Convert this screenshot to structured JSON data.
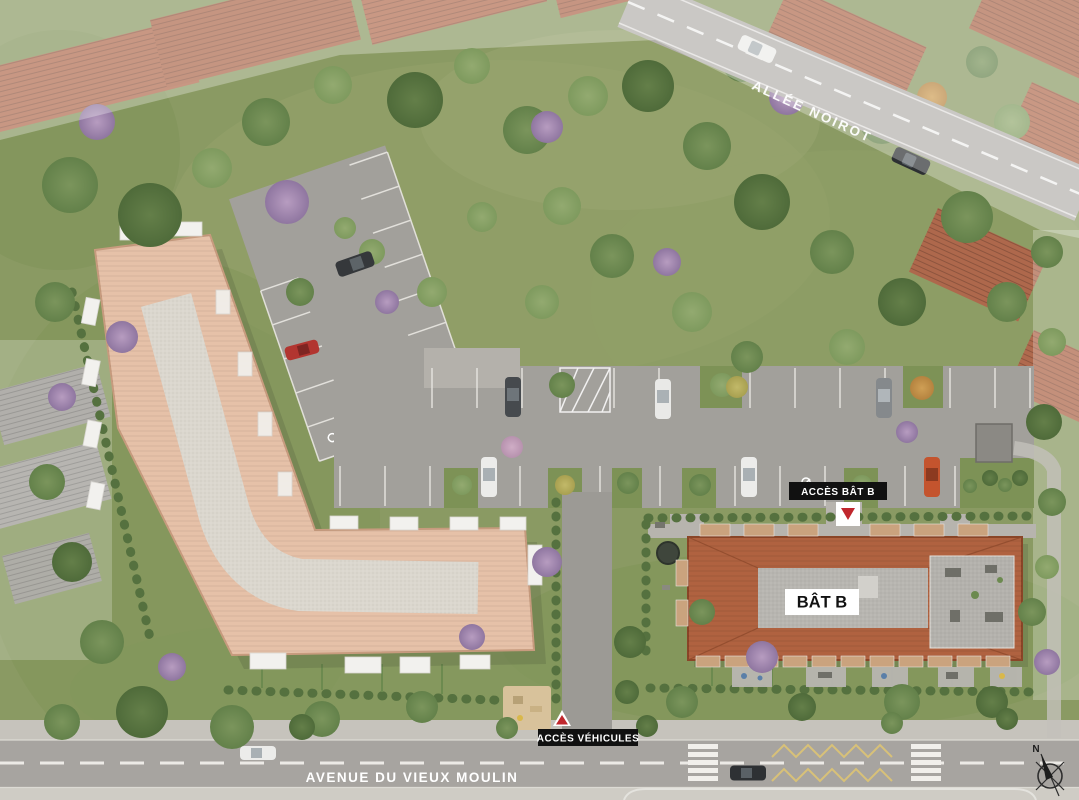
{
  "plan": {
    "type": "residential-site-plan",
    "streets": {
      "top_street": "ALLÉE NOIROT",
      "bottom_street": "AVENUE DU VIEUX MOULIN"
    },
    "buildings": {
      "building_b_label": "BÂT B"
    },
    "markers": {
      "access_building_b": "ACCÈS BÂT B",
      "access_vehicles": "ACCÈS VÉHICULES"
    },
    "compass": {
      "north": "N"
    },
    "colors": {
      "grass": "#8a9a63",
      "asphalt_parking": "#a2a09b",
      "asphalt_road": "#a7a4a0",
      "sidewalk": "#c6c3bc",
      "roof_building_l": "#e6c1a8",
      "roof_building_b": "#b06240",
      "gravel": "#dbd7ce",
      "label_bg": "#111111",
      "label_fg": "#ffffff",
      "accent_red": "#c0272d",
      "marking_yellow": "#d8c178",
      "line_white": "#ffffff"
    }
  }
}
